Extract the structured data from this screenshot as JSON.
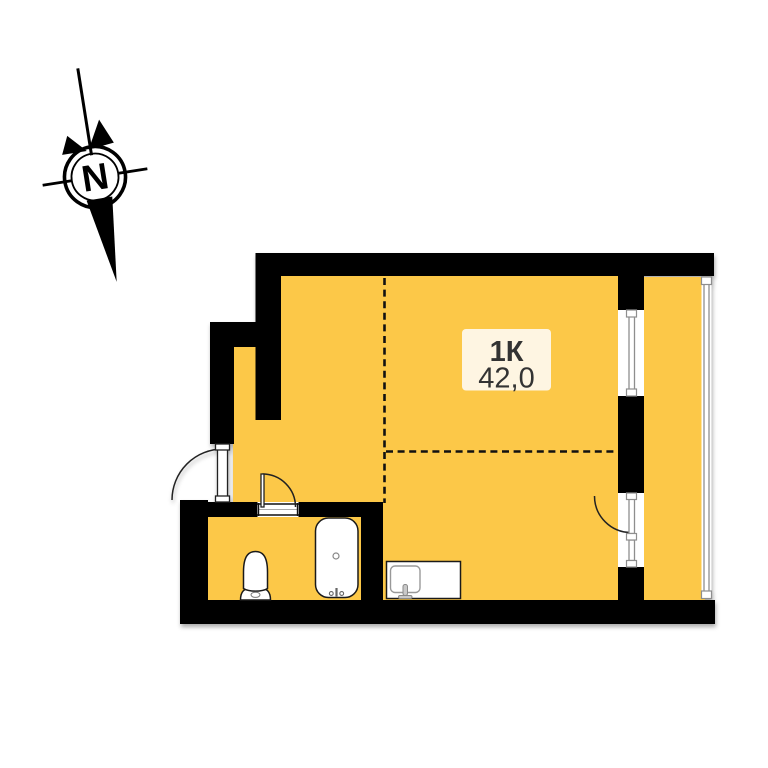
{
  "compass": {
    "label": "N"
  },
  "unit": {
    "type_label": "1К",
    "area_label": "42,0"
  },
  "colors": {
    "background": "#FFFFFF",
    "floor": "#FCC848",
    "balcony_floor": "#FCC848",
    "wall": "#000000",
    "label_box": "#FEF8EB",
    "label_text": "#333333",
    "glazing": "#8E8E8E",
    "door_arc": "#222222"
  }
}
